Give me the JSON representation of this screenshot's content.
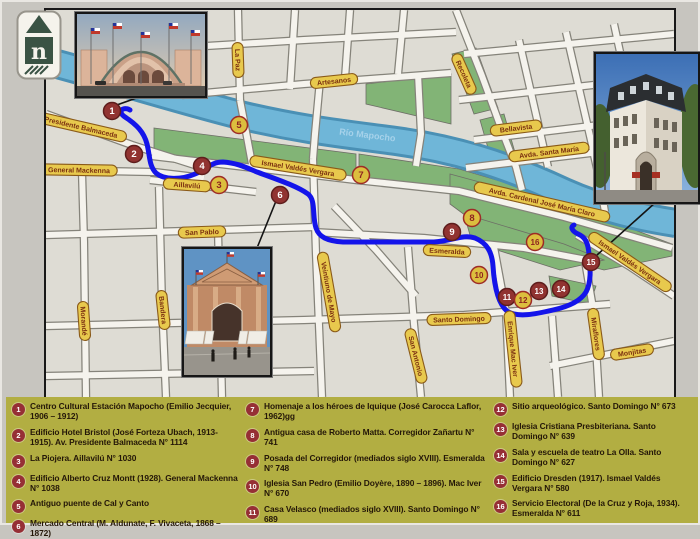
{
  "map": {
    "river_label": {
      "text": "Río Mapocho",
      "x": 363,
      "y": 134,
      "rot": 7
    },
    "street_labels": [
      {
        "text": "Presidente Balmaceda",
        "x": 77,
        "y": 123,
        "rot": 13
      },
      {
        "text": "General Mackenna",
        "x": 75,
        "y": 166,
        "rot": 1
      },
      {
        "text": "Aillavilú",
        "x": 183,
        "y": 181,
        "rot": 4
      },
      {
        "text": "Ismael Valdés Vergara",
        "x": 294,
        "y": 164,
        "rot": 9
      },
      {
        "text": "San Pablo",
        "x": 198,
        "y": 228,
        "rot": -2
      },
      {
        "text": "Morandé",
        "x": 80,
        "y": 317,
        "rot": 86
      },
      {
        "text": "Bandera",
        "x": 159,
        "y": 306,
        "rot": 84
      },
      {
        "text": "Veintiuno de Mayo",
        "x": 325,
        "y": 288,
        "rot": 80
      },
      {
        "text": "San Antonio",
        "x": 412,
        "y": 352,
        "rot": 76
      },
      {
        "text": "Santo Domingo",
        "x": 455,
        "y": 315,
        "rot": -2
      },
      {
        "text": "Esmeralda",
        "x": 443,
        "y": 247,
        "rot": 3
      },
      {
        "text": "Enrique Mac Iver",
        "x": 509,
        "y": 345,
        "rot": 84
      },
      {
        "text": "Miraflores",
        "x": 592,
        "y": 330,
        "rot": 82
      },
      {
        "text": "Monjitas",
        "x": 628,
        "y": 348,
        "rot": -9
      },
      {
        "text": "Avda. Cardenal José María Claro",
        "x": 538,
        "y": 198,
        "rot": 13
      },
      {
        "text": "Ismael Valdés Vergara",
        "x": 626,
        "y": 258,
        "rot": 34
      },
      {
        "text": "La Paz",
        "x": 234,
        "y": 56,
        "rot": 88
      },
      {
        "text": "Artesanos",
        "x": 330,
        "y": 77,
        "rot": -6
      },
      {
        "text": "Recoleta",
        "x": 460,
        "y": 70,
        "rot": 66
      },
      {
        "text": "Bellavista",
        "x": 512,
        "y": 124,
        "rot": -7
      },
      {
        "text": "Avda. Santa María",
        "x": 545,
        "y": 148,
        "rot": -7
      }
    ],
    "markers": [
      {
        "n": "1",
        "x": 108,
        "y": 107,
        "s": "red"
      },
      {
        "n": "2",
        "x": 130,
        "y": 150,
        "s": "red"
      },
      {
        "n": "3",
        "x": 215,
        "y": 181,
        "s": "yellow"
      },
      {
        "n": "4",
        "x": 198,
        "y": 162,
        "s": "red"
      },
      {
        "n": "5",
        "x": 235,
        "y": 121,
        "s": "yellow"
      },
      {
        "n": "6",
        "x": 276,
        "y": 191,
        "s": "red"
      },
      {
        "n": "7",
        "x": 357,
        "y": 171,
        "s": "yellow"
      },
      {
        "n": "8",
        "x": 468,
        "y": 214,
        "s": "yellow"
      },
      {
        "n": "9",
        "x": 448,
        "y": 228,
        "s": "red"
      },
      {
        "n": "10",
        "x": 475,
        "y": 271,
        "s": "yellow"
      },
      {
        "n": "11",
        "x": 503,
        "y": 293,
        "s": "red"
      },
      {
        "n": "12",
        "x": 519,
        "y": 296,
        "s": "yellow"
      },
      {
        "n": "13",
        "x": 535,
        "y": 287,
        "s": "red"
      },
      {
        "n": "14",
        "x": 557,
        "y": 285,
        "s": "red"
      },
      {
        "n": "15",
        "x": 587,
        "y": 258,
        "s": "red"
      },
      {
        "n": "16",
        "x": 531,
        "y": 238,
        "s": "yellow"
      }
    ],
    "colors": {
      "route": "#1414ea",
      "river": "#6fb6d8",
      "river_edge": "#4a90b5",
      "park": "#82b476",
      "pill_bg": "#e8c94d",
      "pill_border": "#8a5a19",
      "pill_text": "#7b3010",
      "marker_red": "#913331",
      "marker_red_border": "#5e1d1c",
      "marker_yellow": "#dcbe3e",
      "marker_yellow_text": "#8e2420",
      "legend_bg": "#b2ae42"
    }
  },
  "logo": {
    "letter": "n"
  },
  "legend": {
    "columns": [
      {
        "items": [
          {
            "n": "1",
            "text": "Centro Cultural Estación Mapocho (Emilio Jecquier, 1906 – 1912)"
          },
          {
            "n": "2",
            "text": "Edificio Hotel Bristol (José Forteza Ubach, 1913- 1915). Av. Presidente Balmaceda N° 1114"
          },
          {
            "n": "3",
            "text": "La Piojera. Aillavilú N° 1030"
          },
          {
            "n": "4",
            "text": "Edificio Alberto Cruz Montt (1928). General Mackenna N° 1038"
          },
          {
            "n": "5",
            "text": "Antiguo puente de Cal y Canto"
          },
          {
            "n": "6",
            "text": "Mercado Central (M. Aldunate, F. Vivaceta, 1868 – 1872)"
          }
        ]
      },
      {
        "items": [
          {
            "n": "7",
            "text": "Homenaje a los héroes de Iquique (José Carocca Laflor, 1962)gg"
          },
          {
            "n": "8",
            "text": "Antigua casa de Roberto Matta. Corregidor Zañartu N° 741"
          },
          {
            "n": "9",
            "text": "Posada del Corregidor (mediados siglo XVIII). Esmeralda N° 748"
          },
          {
            "n": "10",
            "text": "Iglesia San Pedro (Emilio Doyère, 1890 – 1896). Mac Iver N° 670"
          },
          {
            "n": "11",
            "text": "Casa Velasco (mediados siglo XVIII). Santo Domingo N° 689"
          }
        ]
      },
      {
        "items": [
          {
            "n": "12",
            "text": "Sitio arqueológico. Santo Domingo N° 673"
          },
          {
            "n": "13",
            "text": "Iglesia Cristiana Presbiteriana. Santo Domingo N° 639"
          },
          {
            "n": "14",
            "text": "Sala y escuela de teatro La Olla. Santo Domingo N° 627"
          },
          {
            "n": "15",
            "text": "Edificio Dresden (1917). Ismael Valdés Vergara N° 580"
          },
          {
            "n": "16",
            "text": "Servicio Electoral (De la Cruz y Roja, 1934). Esmeralda N° 611"
          }
        ]
      }
    ]
  }
}
